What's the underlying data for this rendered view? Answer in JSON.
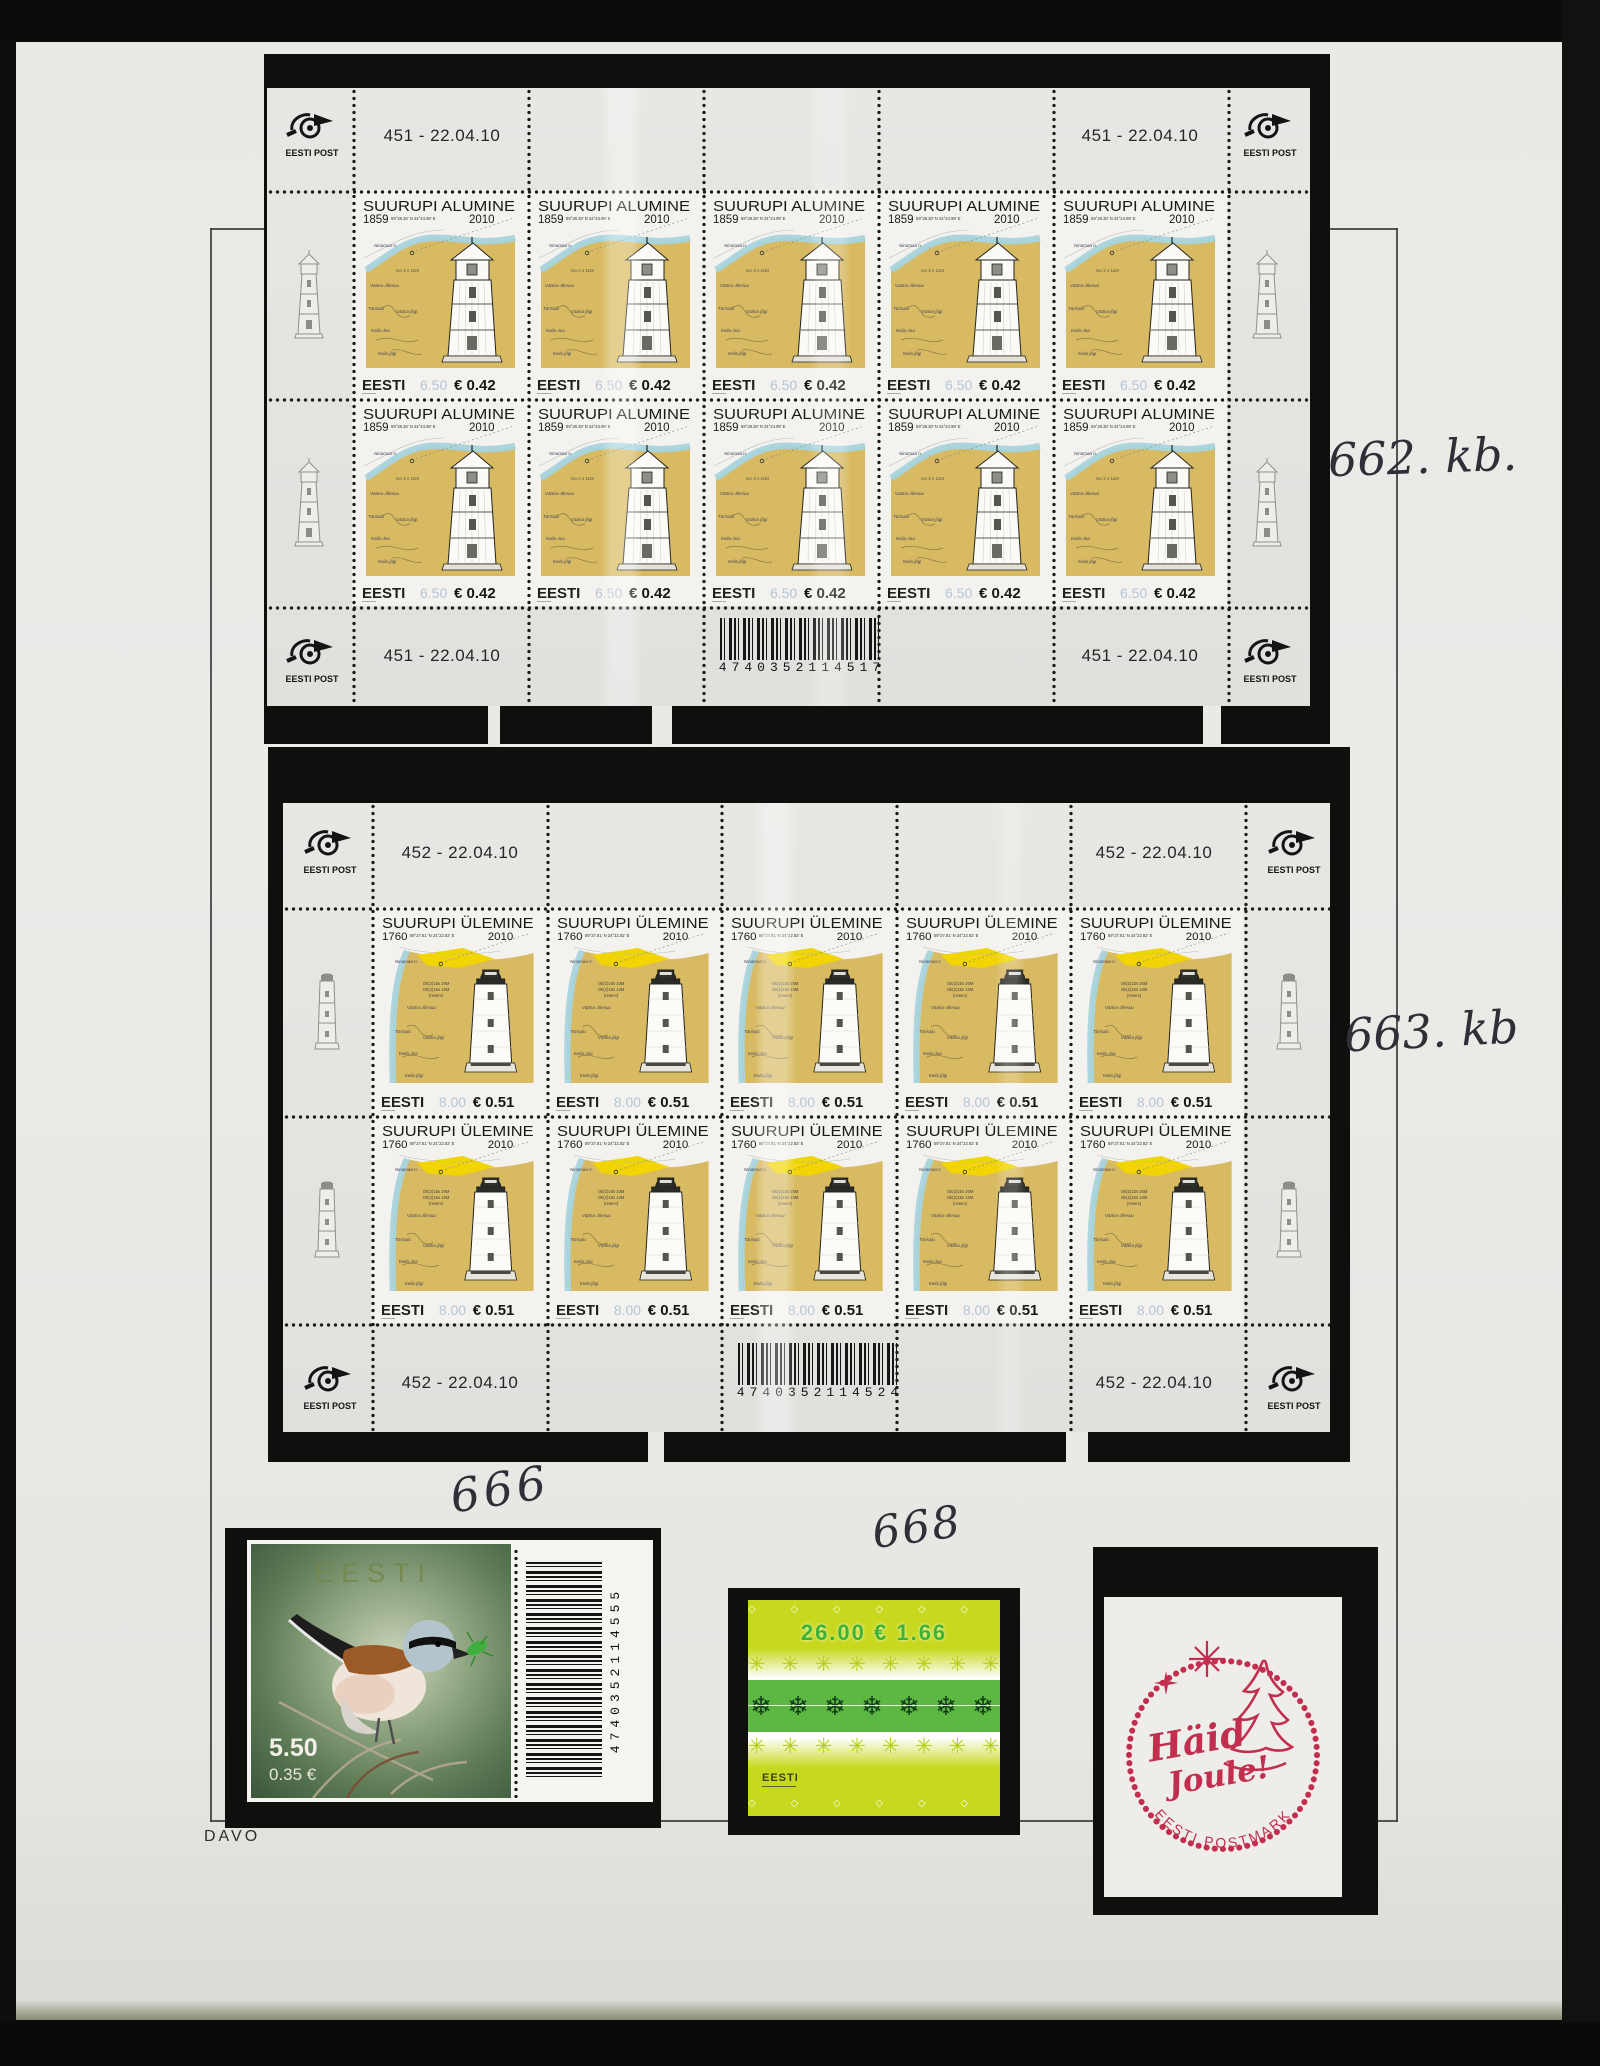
{
  "photo": {
    "album_maker": "DAVO"
  },
  "annotations": {
    "sheet1": "662. kb.",
    "sheet2": "663. kb",
    "bird": "666",
    "green": "668"
  },
  "post_logo": {
    "label": "EESTI POST"
  },
  "sheets": [
    {
      "corner_code": "451 - 22.04.10",
      "barcode": "4740352114517",
      "stamp": {
        "title": "SUURUPI ALUMINE",
        "built": "1859",
        "coords": "59°28.30′ N   24°24.99′ E",
        "issued": "2010",
        "country": "EESTI",
        "kroon": "6.50",
        "euro": "€ 0.42",
        "light_char": "Iso 3 s 11M",
        "map": {
          "l1": "Ninamaa n.",
          "l2": "Vääna-Jõesuu",
          "l3": "Türisalu",
          "l4": "Vääna jõgi",
          "l5": "Keila-Joa",
          "l6": "Keila jõgi"
        }
      }
    },
    {
      "corner_code": "452 - 22.04.10",
      "barcode": "4740352114524",
      "stamp": {
        "title": "SUURUPI ÜLEMINE",
        "built": "1760",
        "coords": "59°27.81′ N   24°22.82′ E",
        "issued": "2010",
        "country": "EESTI",
        "kroon": "8.00",
        "euro": "€ 0.51",
        "light_char1": "Ok(2)15s 20M",
        "light_char2": "Ok(2)15s 10M",
        "light_char3": "(reserv)",
        "map": {
          "l1": "Ninamaa n.",
          "l2": "Vääna-Jõesuu",
          "l3": "Türisalu",
          "l4": "Vääna jõgi",
          "l5": "Keila-Joa",
          "l6": "Keila jõgi"
        }
      }
    }
  ],
  "bird": {
    "country": "EESTI",
    "kroon": "5.50",
    "euro": "0.35 €",
    "barcode": "4740352114555"
  },
  "green": {
    "value_line": "26.00  € 1.66",
    "country": "EESTI",
    "diamond_row": "◇ ◇ ◇ ◇ ◇ ◇ ◇ ◇",
    "snowflake_row_light": "✳ ✳ ✳ ✳ ✳ ✳ ✳ ✳",
    "snowflake_row_dark": "❄ ❄ ❄ ❄ ❄ ❄ ❄"
  },
  "postmark": {
    "greeting1": "Häid",
    "greeting2": "Joule!",
    "ring": "EESTI POSTMARK"
  }
}
